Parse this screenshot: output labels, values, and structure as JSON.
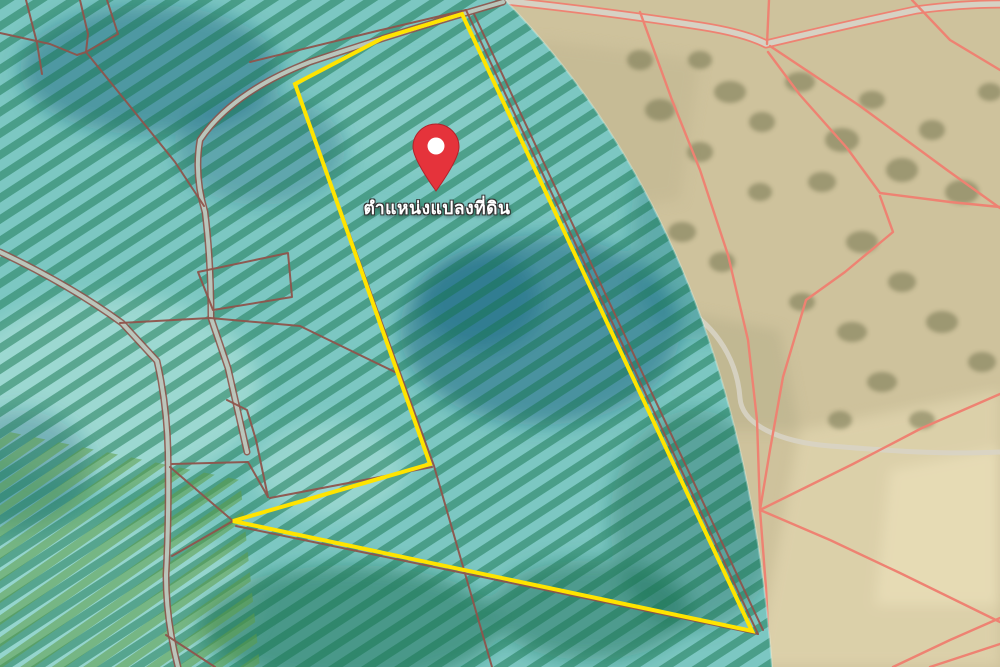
{
  "map": {
    "type": "satellite-cadastral-map-with-overlay-zone",
    "marker": {
      "label": "ตำแหน่งแปลงที่ดิน",
      "icon": "location-pin-icon",
      "pin_color": "#e5333b",
      "pin_hole_color": "#ffffff"
    },
    "parcel_highlight": {
      "outline_color": "#ffe400",
      "outline_width_px": 4
    },
    "overlay_zone": {
      "fill_color": "#7cc7c2",
      "crop_row_hatch_color": "#17754f",
      "dark_patch_color": "#145e7d"
    },
    "cadastral_lines": {
      "color_on_overlay": "#8f544b",
      "color_on_satellite": "#ee8272"
    },
    "basemap": {
      "terrain_color": "#cec29c",
      "tree_color": "#6d6e49",
      "road_fill_color": "#d6d2c4"
    }
  }
}
